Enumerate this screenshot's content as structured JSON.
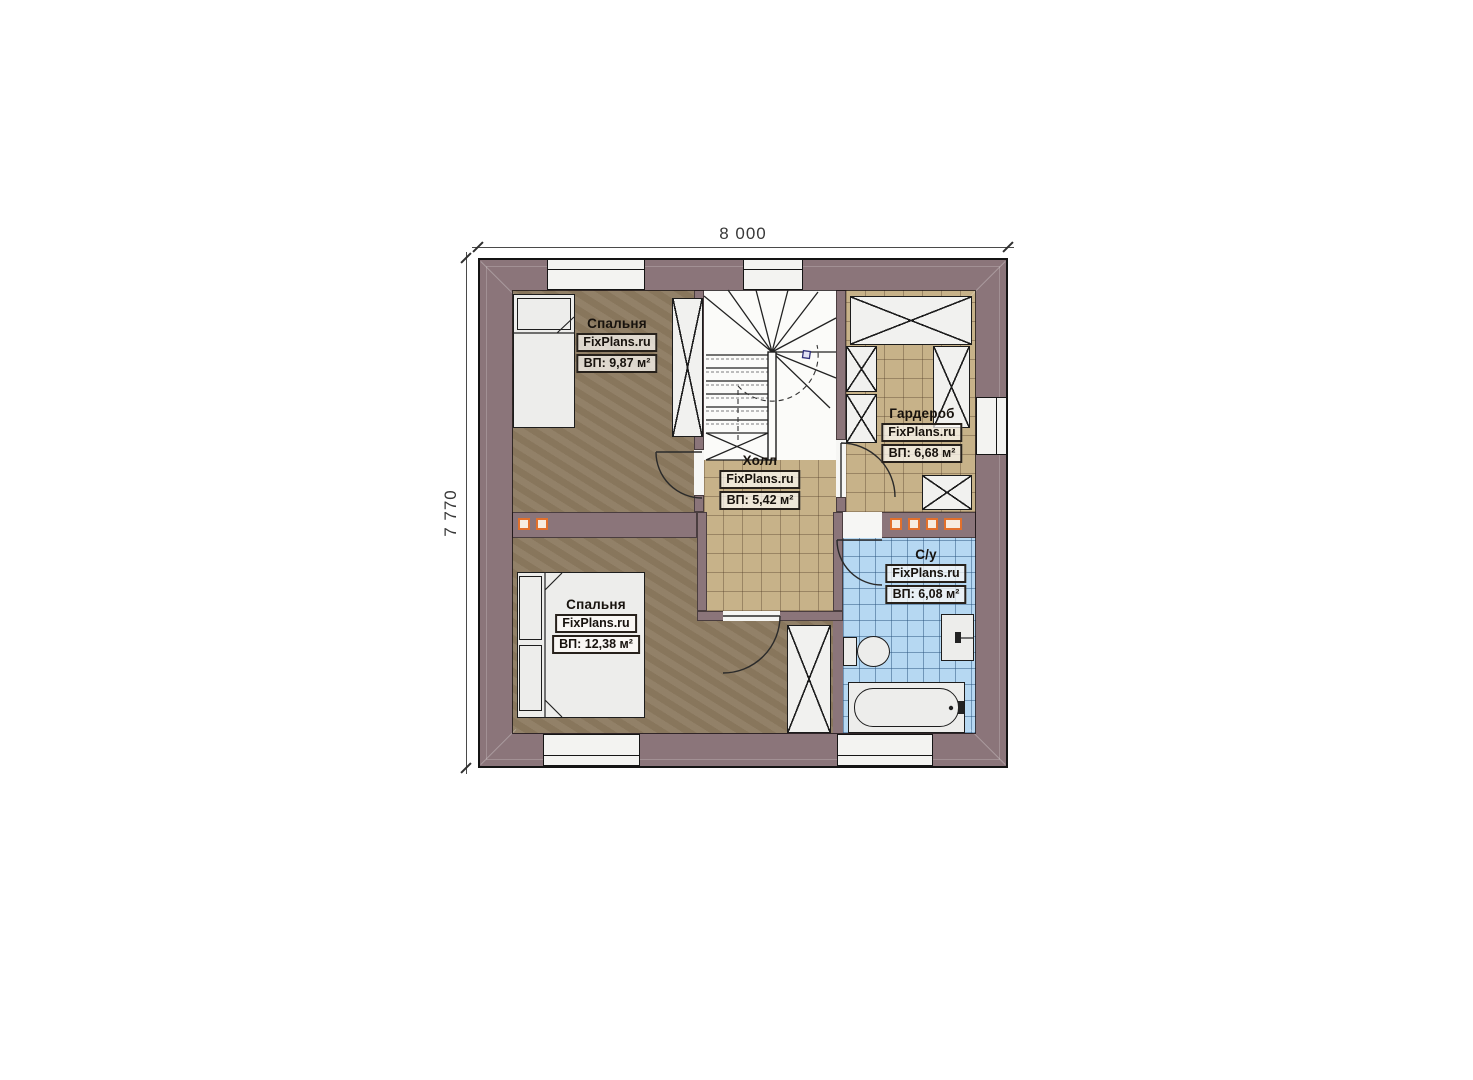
{
  "plan": {
    "watermark": "FixPlans.ru",
    "dimensions": {
      "width": "8 000",
      "height": "7 770"
    },
    "rooms": [
      {
        "name": "Спальня",
        "area_label": "ВП: 9,87 м²"
      },
      {
        "name": "Гардероб",
        "area_label": "ВП: 6,68 м²"
      },
      {
        "name": "Холл",
        "area_label": "ВП: 5,42 м²"
      },
      {
        "name": "Спальня",
        "area_label": "ВП: 12,38 м²"
      },
      {
        "name": "С/у",
        "area_label": "ВП: 6,08 м²"
      }
    ],
    "colors": {
      "wall": "#8b757a",
      "wood_floor": "#8d7b61",
      "tile_floor": "#c7b289",
      "bath_floor": "#b6d8f2",
      "accent_orange": "#e2702c"
    }
  }
}
